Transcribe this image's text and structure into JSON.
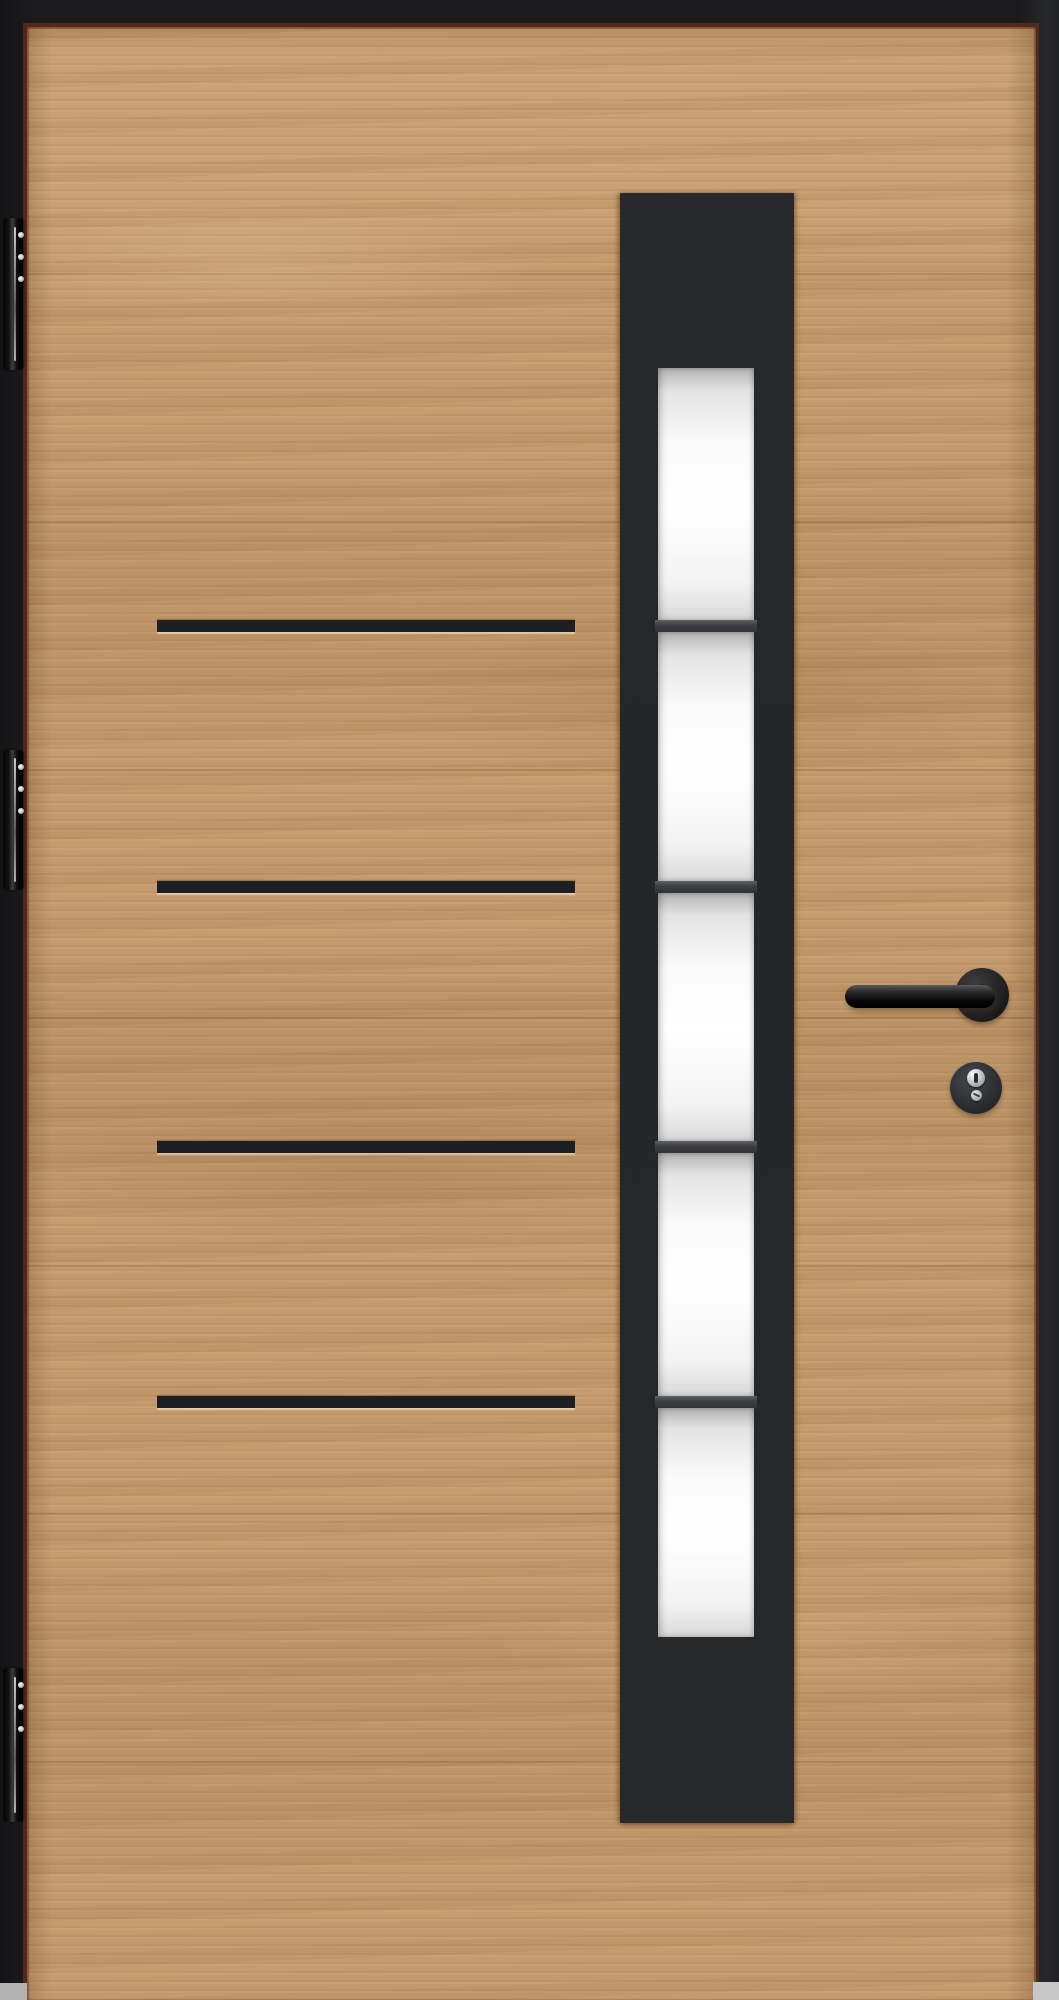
{
  "scene": {
    "description": "Modern entry door: oak woodgrain slab in a black frame with vertical black glazing panel, frosted glass panes and black hardware",
    "door": {
      "label": "oak door slab",
      "grain_direction": "horizontal"
    },
    "frame": {
      "label": "black door frame"
    },
    "glazing": {
      "label": "black glazing panel",
      "pane_count": 5,
      "divider_count": 4,
      "glass_finish": "frosted white"
    },
    "strips": {
      "label": "black inlay strips",
      "count": 4
    },
    "hinges": {
      "label": "black hinges",
      "count": 3,
      "screws_per_hinge": 3
    },
    "hardware": {
      "lever_label": "black lever handle",
      "rosette_label": "round handle rosette",
      "lock_label": "euro profile cylinder escutcheon"
    },
    "floor": {
      "label": "gray floor visible at bottom corners"
    },
    "colors": {
      "frame_black": "#1b1b1d",
      "wood_base": "#c49a6c",
      "wood_shadow": "#7a5030",
      "edge_line": "#52281a",
      "panel_black": "#26282b",
      "strip_black": "#1d1f22",
      "glass_white": "#ffffff",
      "glass_gray": "#b3b3b3",
      "divider_gray": "#3b3e42",
      "hardware_black": "#0e0e10",
      "screw_silver": "#b9bcbf",
      "floor_gray": "#c0c0c0"
    }
  }
}
